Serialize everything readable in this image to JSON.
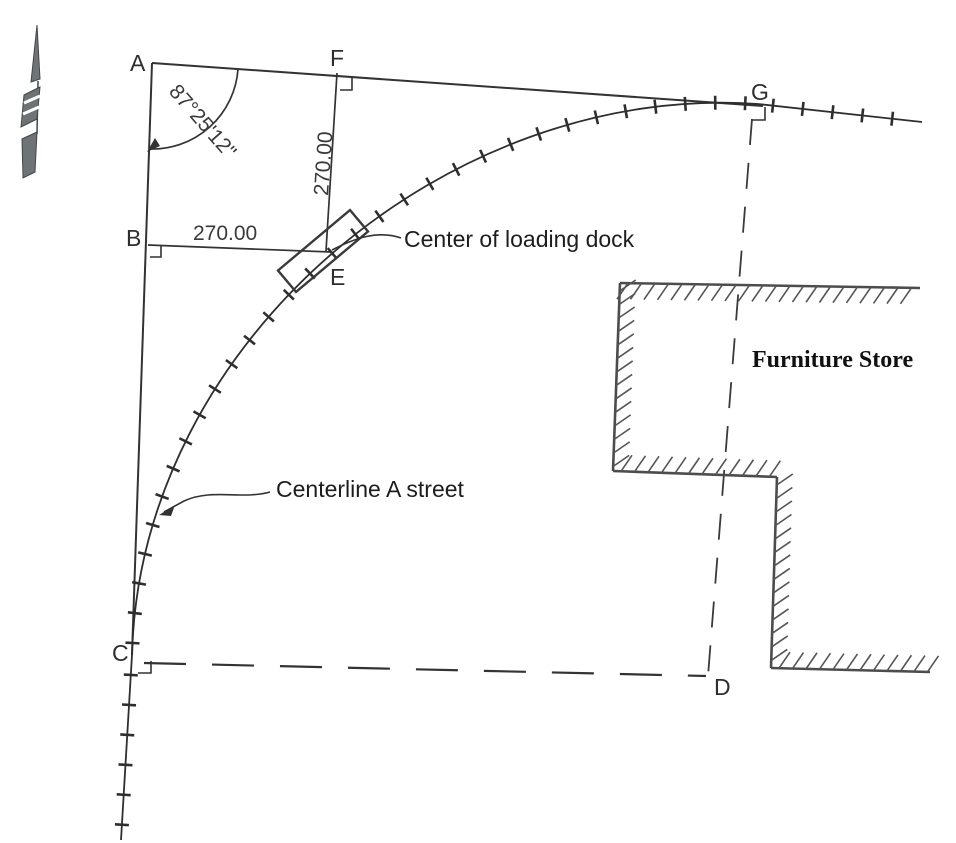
{
  "diagram": {
    "points": {
      "a": "A",
      "b": "B",
      "c": "C",
      "d": "D",
      "e": "E",
      "f": "F",
      "g": "G"
    },
    "angle_label": "87°25'12\"",
    "dimensions": {
      "b_to_e": "270.00",
      "f_to_e": "270.00"
    },
    "annotations": {
      "loading_dock": "Center of loading dock",
      "street": "Centerline A street",
      "building": "Furniture Store"
    },
    "colors": {
      "ink": "#333333",
      "wall": "#4c4c4c",
      "background": "#ffffff"
    }
  }
}
